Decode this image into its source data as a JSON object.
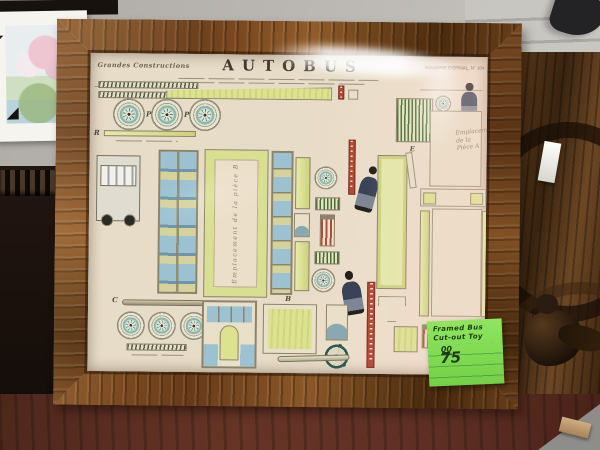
{
  "photo": {
    "poster": {
      "series_label": "Grandes Constructions",
      "title": "AUTOBUS",
      "publisher": "Imagerie d'Épinal, N° 304",
      "caption_center": "Emplacement de la pièce B",
      "caption_right_l1": "Emplacement",
      "caption_right_l2": "de la",
      "caption_right_l3": "Pièce A",
      "letters": {
        "p1": "P",
        "p2": "P",
        "r": "R",
        "c": "C",
        "b": "B",
        "e": "E"
      }
    },
    "price_note": {
      "line1": "Framed Bus",
      "line2": "Cut-out Toy",
      "price_dollars": "75",
      "price_cents": "00"
    },
    "colors": {
      "frame_wood": "#7c4a1f",
      "paper": "#e9decb",
      "piece_yellow": "#dde28f",
      "window_blue": "#9cc2d2",
      "accent_red": "#b24a38",
      "wheel_teal": "#8fb6aa",
      "note_green": "#7edb57",
      "wall_gray": "#b5b2ad",
      "table_wood": "#5d2f23"
    }
  }
}
